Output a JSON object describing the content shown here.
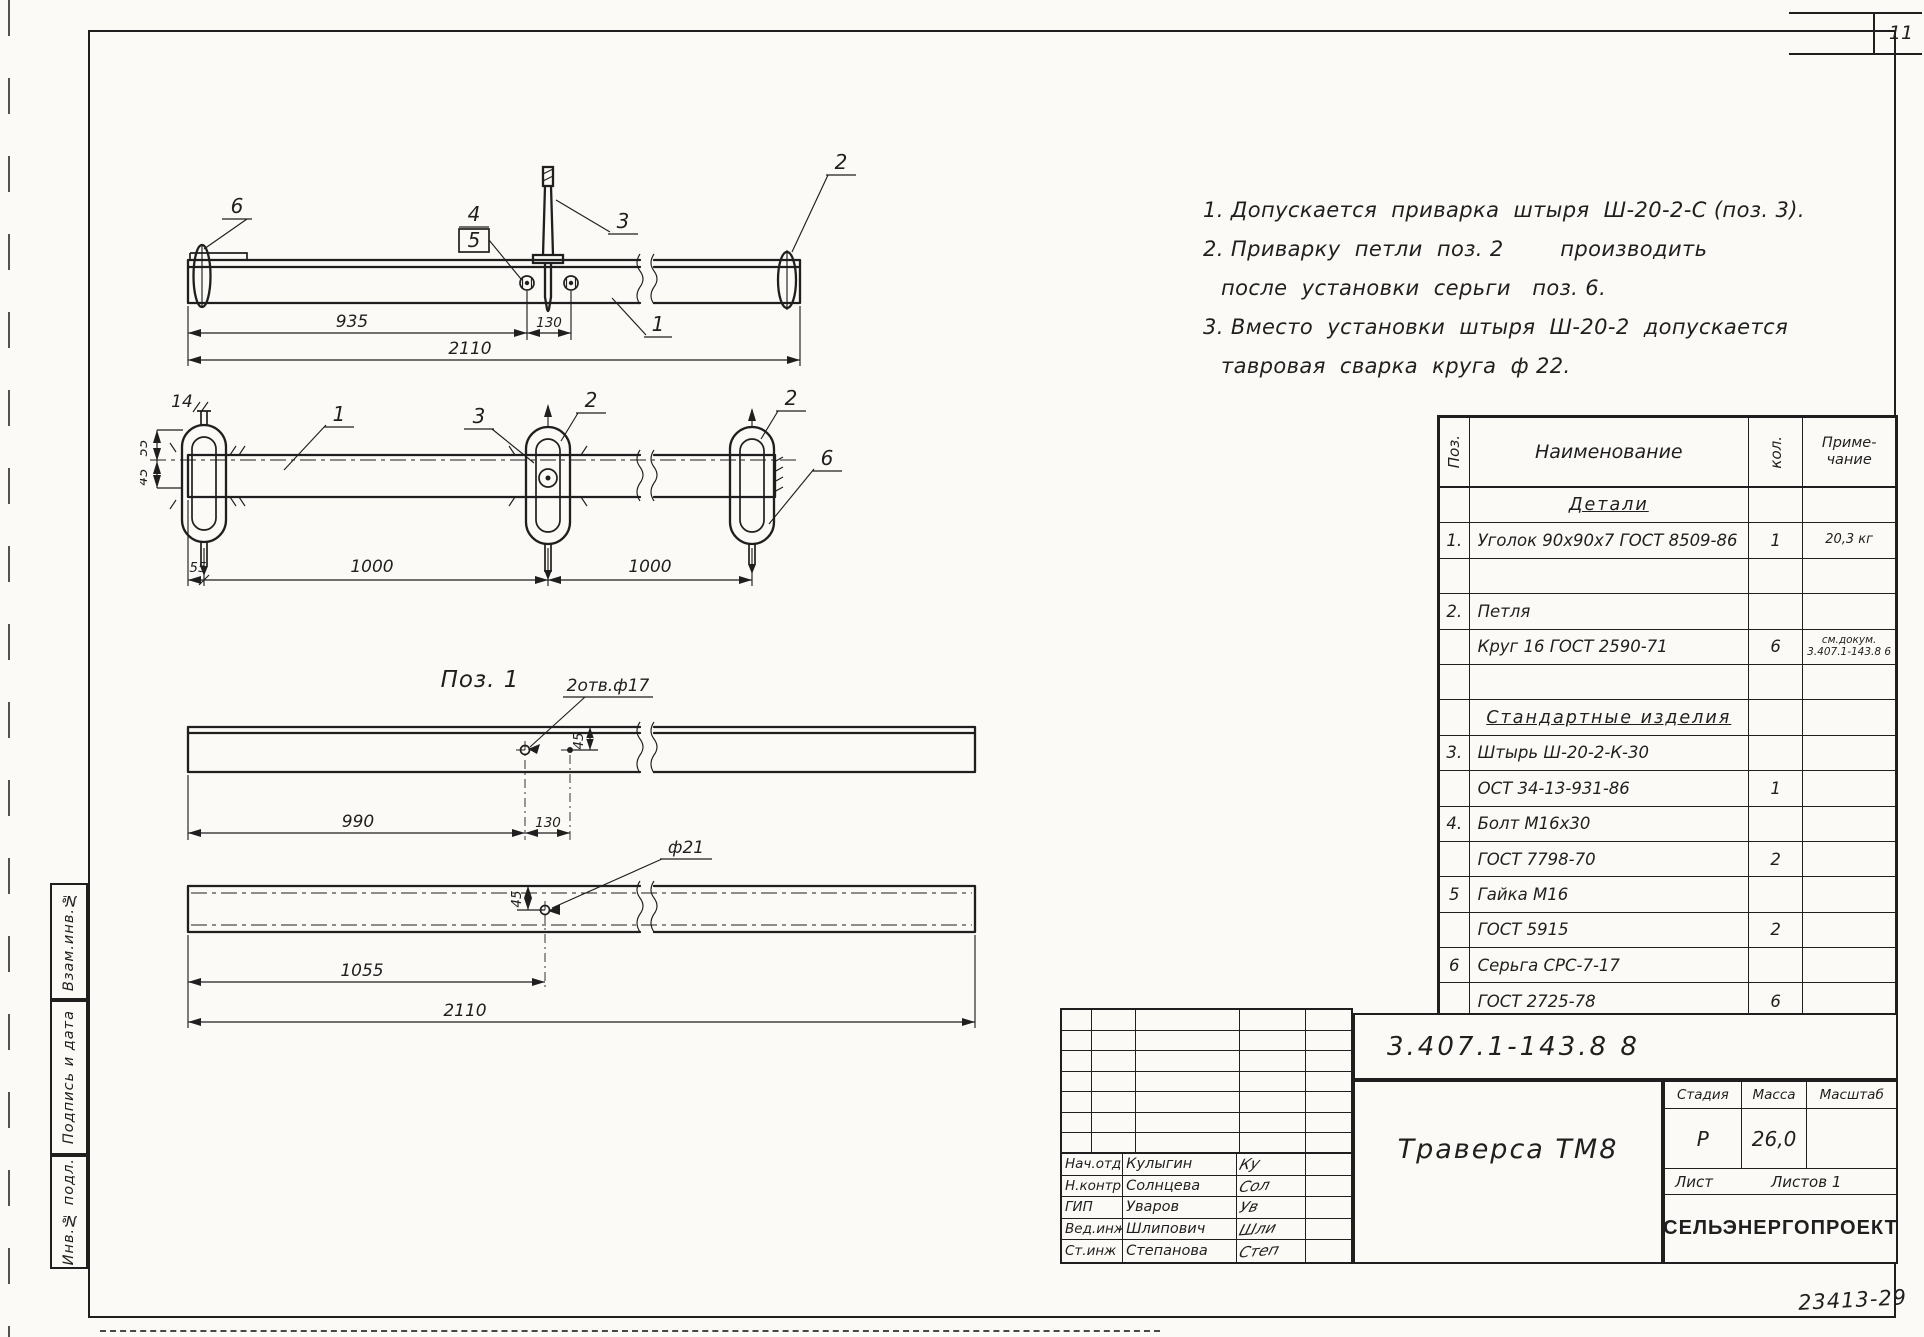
{
  "sheet": {
    "number": "11",
    "footer_code": "23413-29"
  },
  "margin_stamps": [
    {
      "label": "Взам.инв.№"
    },
    {
      "label": "Подпись и дата"
    },
    {
      "label": "Инв.№ подл."
    }
  ],
  "notes": [
    {
      "indent": false,
      "text": "1. Допускается  приварка  штыря  Ш-20-2-С (поз. 3)."
    },
    {
      "indent": false,
      "text": "2. Приварку  петли  поз. 2        производить"
    },
    {
      "indent": true,
      "text": "после  установки  серьги   поз. 6."
    },
    {
      "indent": false,
      "text": "3. Вместо  установки  штыря  Ш-20-2  допускается"
    },
    {
      "indent": true,
      "text": "тавровая  сварка  круга  ф 22."
    }
  ],
  "views": {
    "front": {
      "callouts": {
        "c6": "6",
        "c4": "4",
        "c5": "5",
        "c3": "3",
        "c2": "2",
        "c1": "1"
      },
      "dims": {
        "d935": "935",
        "d130": "130",
        "d2110": "2110"
      }
    },
    "plan": {
      "callouts": {
        "c14": "14",
        "c1": "1",
        "c3": "3",
        "c2m": "2",
        "c2r": "2",
        "c6": "6"
      },
      "dims": {
        "d55v": "55",
        "d45v": "45",
        "d55": "55",
        "d1000a": "1000",
        "d1000b": "1000"
      }
    },
    "detail": {
      "label": "Поз. 1",
      "holes_note": "2отв.ф17",
      "dia_note": "ф21",
      "dims": {
        "d990": "990",
        "d130": "130",
        "d45a": "45",
        "d45b": "45",
        "d1055": "1055",
        "d2110": "2110"
      }
    }
  },
  "parts_table": {
    "col_pos": "Поз.",
    "col_name": "Наименование",
    "col_qty": "кол.",
    "col_note_1": "Приме-",
    "col_note_2": "чание",
    "rows": [
      {
        "type": "section",
        "name": "Детали"
      },
      {
        "type": "item",
        "pos": "1.",
        "name": "Уголок 90х90х7 ГОСТ 8509-86",
        "qty": "1",
        "note": "20,3 кг"
      },
      {
        "type": "blank"
      },
      {
        "type": "item",
        "pos": "2.",
        "name": "Петля",
        "qty": "",
        "note": ""
      },
      {
        "type": "item",
        "pos": "",
        "name": "Круг 16 ГОСТ 2590-71",
        "qty": "6",
        "note_line1": "см.докум.",
        "note_line2": "3.407.1-143.8 6"
      },
      {
        "type": "blank"
      },
      {
        "type": "section",
        "name": "Стандартные изделия"
      },
      {
        "type": "item",
        "pos": "3.",
        "name": "Штырь Ш-20-2-К-30",
        "qty": "",
        "note": ""
      },
      {
        "type": "item",
        "pos": "",
        "name": "ОСТ 34-13-931-86",
        "qty": "1",
        "note": ""
      },
      {
        "type": "item",
        "pos": "4.",
        "name": "Болт М16х30",
        "qty": "",
        "note": ""
      },
      {
        "type": "item",
        "pos": "",
        "name": "ГОСТ 7798-70",
        "qty": "2",
        "note": ""
      },
      {
        "type": "item",
        "pos": "5",
        "name": "Гайка М16",
        "qty": "",
        "note": ""
      },
      {
        "type": "item",
        "pos": "",
        "name": "ГОСТ 5915",
        "qty": "2",
        "note": ""
      },
      {
        "type": "item",
        "pos": "6",
        "name": "Серьга СРС-7-17",
        "qty": "",
        "note": ""
      },
      {
        "type": "item",
        "pos": "",
        "name": "ГОСТ 2725-78",
        "qty": "6",
        "note": ""
      }
    ]
  },
  "title_block": {
    "doc_number": "3.407.1-143.8 8",
    "product_title": "Траверса ТМ8",
    "stage_label": "Стадия",
    "mass_label": "Масса",
    "scale_label": "Масштаб",
    "stage_value": "Р",
    "mass_value": "26,0",
    "scale_value": "",
    "sheet_label": "Лист",
    "sheets_label": "Листов 1",
    "organization": "СЕЛЬЭНЕРГОПРОЕКТ",
    "signatures": [
      {
        "role": "Нач.отд",
        "name": "Кулыгин",
        "sig": "Ку"
      },
      {
        "role": "Н.контр.",
        "name": "Солнцева",
        "sig": "Сол"
      },
      {
        "role": "ГИП",
        "name": "Уваров",
        "sig": "Ув"
      },
      {
        "role": "Вед.инж.",
        "name": "Шлипович",
        "sig": "Шли"
      },
      {
        "role": "Ст.инж",
        "name": "Степанова",
        "sig": "Степ"
      }
    ]
  }
}
